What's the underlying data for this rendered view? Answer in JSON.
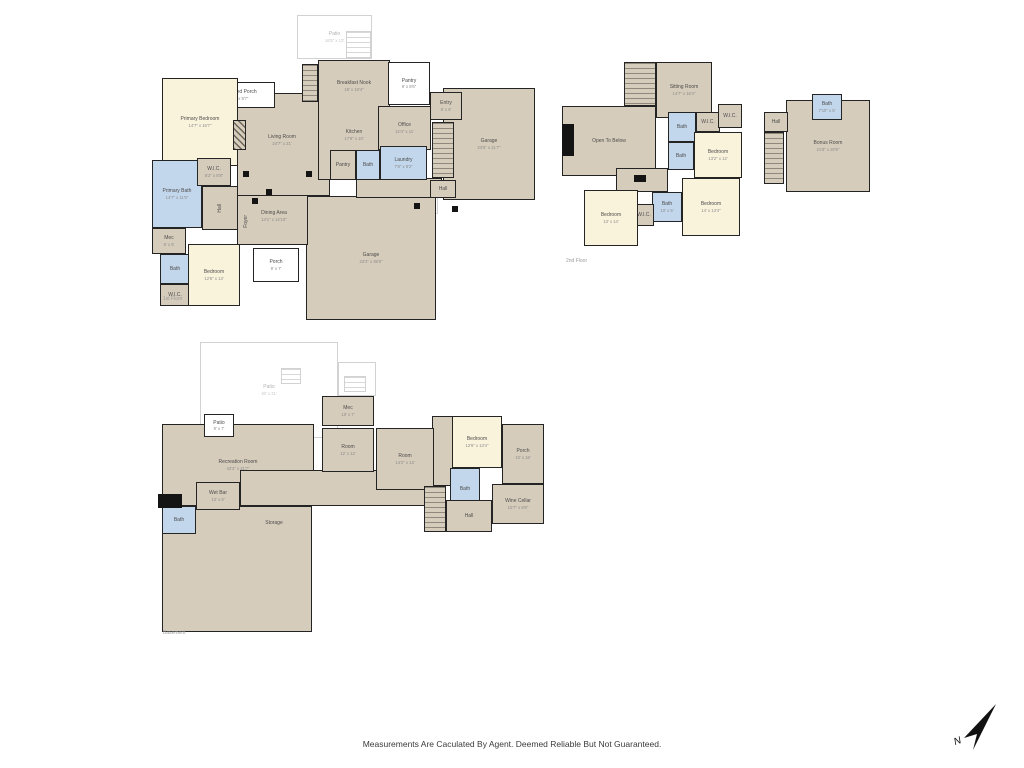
{
  "disclaimer": "Measurements Are Caculated By Agent. Deemed Reliable But Not Guaranteed.",
  "compass": {
    "label": "N"
  },
  "palette": {
    "tan": "#d6ccbb",
    "cream": "#faf3dc",
    "blue": "#c3d7ec",
    "white": "#ffffff",
    "wall": "#242424",
    "outline_line": "#d2d2d2",
    "solid": "#141414"
  },
  "floors": [
    {
      "name": "first-floor",
      "caption": "1st Floor",
      "rooms": [
        {
          "label": "Patio",
          "dims": "16'5\" x 13'",
          "type": "outline",
          "x": 297,
          "y": 15,
          "w": 75,
          "h": 44
        },
        {
          "type": "outline-stairs",
          "x": 346,
          "y": 31,
          "w": 25,
          "h": 27
        },
        {
          "label": "Patio",
          "type": "outline",
          "x": 398,
          "y": 192,
          "w": 40,
          "h": 22
        },
        {
          "label": "Garage",
          "dims": "23'6\" x 21'7\"",
          "type": "tan",
          "x": 443,
          "y": 88,
          "w": 92,
          "h": 112
        },
        {
          "label": "Garage",
          "dims": "23'4\" x 35'6\"",
          "type": "tan",
          "x": 306,
          "y": 196,
          "w": 130,
          "h": 124
        },
        {
          "type": "tan",
          "x": 237,
          "y": 93,
          "w": 93,
          "h": 103
        },
        {
          "type": "tan",
          "x": 237,
          "y": 195,
          "w": 71,
          "h": 50
        },
        {
          "type": "tan",
          "x": 318,
          "y": 60,
          "w": 72,
          "h": 120
        },
        {
          "type": "tan",
          "x": 356,
          "y": 178,
          "w": 86,
          "h": 20
        },
        {
          "label": "Covered Porch",
          "dims": "15' x 9'7\"",
          "type": "white",
          "x": 205,
          "y": 82,
          "w": 70,
          "h": 26
        },
        {
          "label": "Primary Bedroom",
          "dims": "14'7\" x 16'7\"",
          "type": "cream",
          "x": 162,
          "y": 78,
          "w": 76,
          "h": 88
        },
        {
          "label": "Primary Bath",
          "dims": "14'7\" x 11'5\"",
          "type": "blue",
          "x": 152,
          "y": 160,
          "w": 50,
          "h": 68
        },
        {
          "label": "W.I.C.",
          "dims": "6'2\" x 5'8\"",
          "type": "tan",
          "x": 197,
          "y": 158,
          "w": 34,
          "h": 28
        },
        {
          "label": "Hall",
          "type": "tan",
          "x": 202,
          "y": 186,
          "w": 36,
          "h": 44,
          "vert": true
        },
        {
          "label": "Mec",
          "dims": "6' x 5'",
          "type": "tan",
          "x": 152,
          "y": 228,
          "w": 34,
          "h": 26
        },
        {
          "label": "Bath",
          "type": "blue",
          "x": 160,
          "y": 254,
          "w": 30,
          "h": 30
        },
        {
          "label": "W.I.C.",
          "type": "tan",
          "x": 160,
          "y": 284,
          "w": 30,
          "h": 22
        },
        {
          "label": "Bedroom",
          "dims": "12'6\" x 13'",
          "type": "cream",
          "x": 188,
          "y": 244,
          "w": 52,
          "h": 62
        },
        {
          "label": "Pantry",
          "dims": "9' x 8'6\"",
          "type": "white",
          "x": 388,
          "y": 62,
          "w": 42,
          "h": 43
        },
        {
          "label": "Office",
          "dims": "12'4\" x 11'",
          "type": "tan",
          "x": 378,
          "y": 106,
          "w": 53,
          "h": 44
        },
        {
          "label": "Pantry",
          "type": "tan",
          "x": 330,
          "y": 150,
          "w": 26,
          "h": 30
        },
        {
          "label": "Bath",
          "type": "blue",
          "x": 356,
          "y": 150,
          "w": 24,
          "h": 30
        },
        {
          "label": "Laundry",
          "dims": "7'8\" x 9'2\"",
          "type": "blue",
          "x": 380,
          "y": 146,
          "w": 47,
          "h": 34
        },
        {
          "label": "Porch",
          "dims": "9' x 7'",
          "type": "white",
          "x": 253,
          "y": 248,
          "w": 46,
          "h": 34
        },
        {
          "label": "Entry",
          "dims": "6' x 6'",
          "type": "tan",
          "x": 430,
          "y": 92,
          "w": 32,
          "h": 28
        },
        {
          "label": "Hall",
          "type": "tan",
          "x": 430,
          "y": 180,
          "w": 26,
          "h": 18
        },
        {
          "type": "stairs",
          "x": 432,
          "y": 122,
          "w": 22,
          "h": 56
        },
        {
          "type": "stairs",
          "x": 302,
          "y": 64,
          "w": 16,
          "h": 38
        },
        {
          "label": "Living Room",
          "dims": "24'7\" x 21'",
          "type": "label",
          "x": 247,
          "y": 130,
          "w": 70,
          "h": 20
        },
        {
          "label": "Breakfast Nook",
          "dims": "16' x 10'4\"",
          "type": "label",
          "x": 322,
          "y": 76,
          "w": 64,
          "h": 20
        },
        {
          "label": "Kitchen",
          "dims": "17'6\" x 10'",
          "type": "label",
          "x": 322,
          "y": 126,
          "w": 64,
          "h": 18
        },
        {
          "label": "Dining Area",
          "dims": "14'1\" x 14'10\"",
          "type": "label",
          "x": 242,
          "y": 206,
          "w": 64,
          "h": 20
        },
        {
          "label": "Foyer",
          "type": "label",
          "x": 240,
          "y": 198,
          "w": 13,
          "h": 46,
          "vert": true
        },
        {
          "type": "hatch",
          "x": 233,
          "y": 120,
          "w": 13,
          "h": 30
        },
        {
          "type": "solid",
          "x": 243,
          "y": 171,
          "w": 6,
          "h": 6
        },
        {
          "type": "solid",
          "x": 266,
          "y": 189,
          "w": 6,
          "h": 6
        },
        {
          "type": "solid",
          "x": 306,
          "y": 171,
          "w": 6,
          "h": 6
        },
        {
          "type": "solid",
          "x": 252,
          "y": 198,
          "w": 6,
          "h": 6
        },
        {
          "type": "solid",
          "x": 414,
          "y": 203,
          "w": 6,
          "h": 6
        },
        {
          "type": "solid",
          "x": 452,
          "y": 206,
          "w": 6,
          "h": 6
        }
      ]
    },
    {
      "name": "second-floor",
      "caption": "2nd Floor",
      "rooms": [
        {
          "label": "Open To Below",
          "type": "tan",
          "x": 562,
          "y": 106,
          "w": 94,
          "h": 70
        },
        {
          "label": "Sitting Room",
          "dims": "14'7\" x 16'4\"",
          "type": "tan",
          "x": 656,
          "y": 62,
          "w": 56,
          "h": 56
        },
        {
          "type": "stairs",
          "x": 624,
          "y": 62,
          "w": 32,
          "h": 44
        },
        {
          "label": "Hall",
          "type": "tan",
          "x": 616,
          "y": 168,
          "w": 52,
          "h": 24
        },
        {
          "label": "Bath",
          "type": "blue",
          "x": 668,
          "y": 112,
          "w": 28,
          "h": 30
        },
        {
          "label": "W.I.C.",
          "type": "tan",
          "x": 696,
          "y": 112,
          "w": 24,
          "h": 20
        },
        {
          "label": "W.I.C.",
          "type": "tan",
          "x": 718,
          "y": 104,
          "w": 24,
          "h": 24
        },
        {
          "label": "Bedroom",
          "dims": "13'2\" x 12'",
          "type": "cream",
          "x": 694,
          "y": 132,
          "w": 48,
          "h": 46
        },
        {
          "label": "Bath",
          "type": "blue",
          "x": 668,
          "y": 142,
          "w": 26,
          "h": 28
        },
        {
          "label": "Bath",
          "dims": "10' x 5'",
          "type": "blue",
          "x": 652,
          "y": 192,
          "w": 30,
          "h": 30
        },
        {
          "label": "W.I.C.",
          "type": "tan",
          "x": 634,
          "y": 204,
          "w": 20,
          "h": 22
        },
        {
          "label": "Bedroom",
          "dims": "14' x 13'4\"",
          "type": "cream",
          "x": 682,
          "y": 178,
          "w": 58,
          "h": 58
        },
        {
          "label": "Bedroom",
          "dims": "13' x 14'",
          "type": "cream",
          "x": 584,
          "y": 190,
          "w": 54,
          "h": 56
        },
        {
          "type": "solid",
          "x": 562,
          "y": 124,
          "w": 12,
          "h": 32
        },
        {
          "type": "solid",
          "x": 634,
          "y": 175,
          "w": 12,
          "h": 7
        }
      ]
    },
    {
      "name": "bonus-floor",
      "caption": "",
      "rooms": [
        {
          "label": "Bonus Room",
          "dims": "21'6\" x 20'5\"",
          "type": "tan",
          "x": 786,
          "y": 100,
          "w": 84,
          "h": 92
        },
        {
          "label": "Bath",
          "dims": "7'10\" x 5'",
          "type": "blue",
          "x": 812,
          "y": 94,
          "w": 30,
          "h": 26
        },
        {
          "label": "Hall",
          "type": "tan",
          "x": 764,
          "y": 112,
          "w": 24,
          "h": 20
        },
        {
          "type": "stairs",
          "x": 764,
          "y": 132,
          "w": 20,
          "h": 52
        }
      ]
    },
    {
      "name": "basement",
      "caption": "Basement",
      "rooms": [
        {
          "label": "Patio",
          "dims": "40' x 21'",
          "type": "outline",
          "x": 200,
          "y": 342,
          "w": 138,
          "h": 96
        },
        {
          "type": "outline",
          "x": 338,
          "y": 362,
          "w": 38,
          "h": 34
        },
        {
          "type": "outline-stairs",
          "x": 281,
          "y": 368,
          "w": 20,
          "h": 16
        },
        {
          "type": "outline-stairs",
          "x": 344,
          "y": 376,
          "w": 22,
          "h": 16
        },
        {
          "label": "Recreation Room",
          "dims": "43'2\" x 21'7\"",
          "type": "tan",
          "x": 162,
          "y": 424,
          "w": 152,
          "h": 82
        },
        {
          "type": "tan",
          "x": 240,
          "y": 470,
          "w": 200,
          "h": 36
        },
        {
          "type": "tan",
          "x": 162,
          "y": 506,
          "w": 150,
          "h": 126
        },
        {
          "type": "tan",
          "x": 432,
          "y": 416,
          "w": 22,
          "h": 70
        },
        {
          "label": "Patio",
          "dims": "9' x 7'",
          "type": "white",
          "x": 204,
          "y": 414,
          "w": 30,
          "h": 23
        },
        {
          "label": "Wet Bar",
          "dims": "12' x 8'",
          "type": "tan",
          "x": 196,
          "y": 482,
          "w": 44,
          "h": 28
        },
        {
          "label": "Bath",
          "type": "blue",
          "x": 162,
          "y": 506,
          "w": 34,
          "h": 28
        },
        {
          "label": "Mec",
          "dims": "10' x 7'",
          "type": "tan",
          "x": 322,
          "y": 396,
          "w": 52,
          "h": 30
        },
        {
          "label": "Room",
          "dims": "12' x 12'",
          "type": "tan",
          "x": 322,
          "y": 428,
          "w": 52,
          "h": 44
        },
        {
          "label": "Room",
          "dims": "14'2\" x 13'",
          "type": "tan",
          "x": 376,
          "y": 428,
          "w": 58,
          "h": 62
        },
        {
          "label": "Bedroom",
          "dims": "12'6\" x 13'4\"",
          "type": "cream",
          "x": 452,
          "y": 416,
          "w": 50,
          "h": 52
        },
        {
          "label": "Porch",
          "dims": "10' x 16'",
          "type": "tan",
          "x": 502,
          "y": 424,
          "w": 42,
          "h": 60
        },
        {
          "label": "Bath",
          "type": "blue",
          "x": 450,
          "y": 468,
          "w": 30,
          "h": 42
        },
        {
          "label": "Wine Cellar",
          "dims": "10'7\" x 8'6\"",
          "type": "tan",
          "x": 492,
          "y": 484,
          "w": 52,
          "h": 40
        },
        {
          "label": "Hall",
          "type": "tan",
          "x": 446,
          "y": 500,
          "w": 46,
          "h": 32
        },
        {
          "type": "stairs",
          "x": 424,
          "y": 486,
          "w": 22,
          "h": 46
        },
        {
          "label": "Storage",
          "type": "label",
          "x": 244,
          "y": 516,
          "w": 60,
          "h": 14
        },
        {
          "type": "solid",
          "x": 158,
          "y": 494,
          "w": 24,
          "h": 14
        }
      ]
    }
  ]
}
